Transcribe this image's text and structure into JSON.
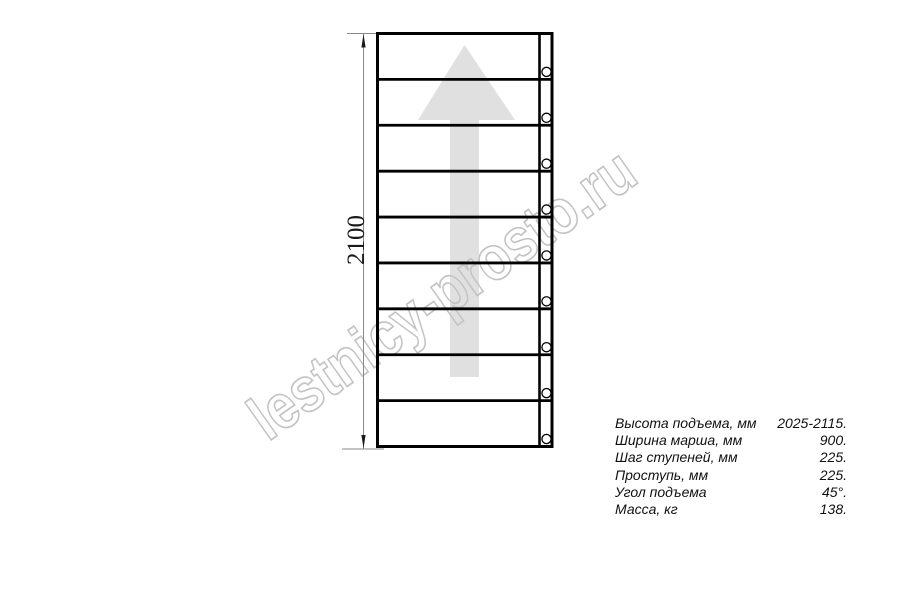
{
  "watermark": {
    "text": "lestnicy-prosto.ru"
  },
  "colors": {
    "watermark": "#c3c3c3",
    "arrow": "#e0e0e0",
    "drawing_line": "#000000",
    "dimension_line": "#8a8a8a",
    "text": "#111111"
  },
  "diagram": {
    "dimension_label": "2100",
    "steps_count": 9,
    "screws_count": 9
  },
  "specs": {
    "rows": [
      {
        "label": "Высота подъема, мм",
        "value": "2025-2115."
      },
      {
        "label": "Ширина марша, мм",
        "value": "900."
      },
      {
        "label": "Шаг ступеней, мм",
        "value": "225."
      },
      {
        "label": "Проступь, мм",
        "value": "225."
      },
      {
        "label": "Угол подъема",
        "value": "45°."
      },
      {
        "label": "Масса, кг",
        "value": "138."
      }
    ]
  }
}
